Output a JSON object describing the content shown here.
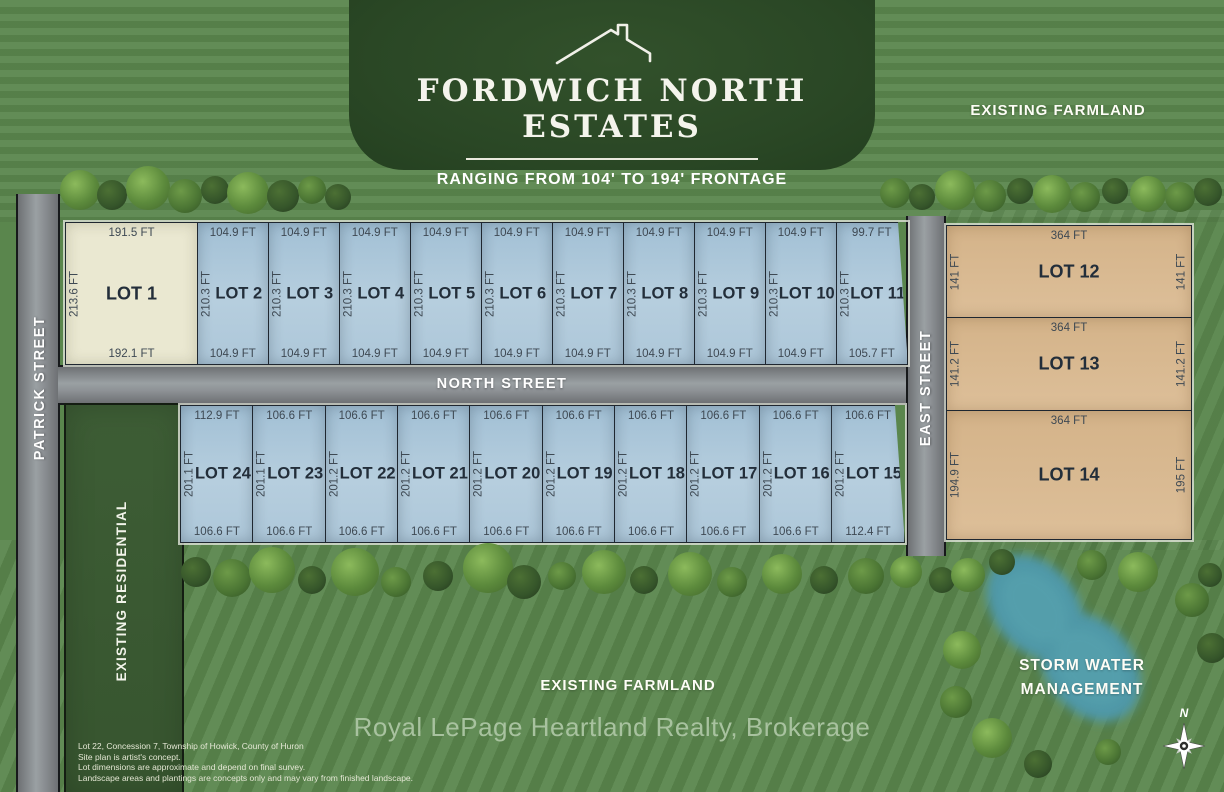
{
  "header": {
    "title": "FORDWICH NORTH ESTATES",
    "subtitle": "RANGING FROM  104' TO 194' FRONTAGE"
  },
  "streets": {
    "patrick": "PATRICK STREET",
    "north": "NORTH STREET",
    "east": "EAST STREET"
  },
  "areas": {
    "existing_farmland_top": "EXISTING FARMLAND",
    "existing_farmland_bottom": "EXISTING FARMLAND",
    "existing_residential": "EXISTING RESIDENTIAL",
    "storm_water_line1": "STORM WATER",
    "storm_water_line2": "MANAGEMENT"
  },
  "compass": {
    "north": "N"
  },
  "footer": {
    "brokerage": "Royal LePage Heartland Realty, Brokerage"
  },
  "disclaimer": [
    "Lot 22, Concession 7, Township of Howick, County of Huron",
    "Site plan is artist's concept.",
    "Lot dimensions are approximate and depend on final survey.",
    "Landscape areas and plantings are concepts only and may vary from finished landscape."
  ],
  "lots": {
    "top_row": [
      {
        "name": "lot-1",
        "label": "LOT 1",
        "top_dim": "191.5 FT",
        "bottom_dim": "192.1 FT",
        "side_dim": "213.6 FT",
        "fill": "cream"
      },
      {
        "name": "lot-2",
        "label": "LOT 2",
        "top_dim": "104.9 FT",
        "bottom_dim": "104.9 FT",
        "side_dim": "210.3 FT",
        "fill": "blue"
      },
      {
        "name": "lot-3",
        "label": "LOT 3",
        "top_dim": "104.9 FT",
        "bottom_dim": "104.9 FT",
        "side_dim": "210.3 FT",
        "fill": "blue"
      },
      {
        "name": "lot-4",
        "label": "LOT 4",
        "top_dim": "104.9 FT",
        "bottom_dim": "104.9 FT",
        "side_dim": "210.3 FT",
        "fill": "blue"
      },
      {
        "name": "lot-5",
        "label": "LOT 5",
        "top_dim": "104.9 FT",
        "bottom_dim": "104.9 FT",
        "side_dim": "210.3 FT",
        "fill": "blue"
      },
      {
        "name": "lot-6",
        "label": "LOT 6",
        "top_dim": "104.9 FT",
        "bottom_dim": "104.9 FT",
        "side_dim": "210.3 FT",
        "fill": "blue"
      },
      {
        "name": "lot-7",
        "label": "LOT 7",
        "top_dim": "104.9 FT",
        "bottom_dim": "104.9 FT",
        "side_dim": "210.3 FT",
        "fill": "blue"
      },
      {
        "name": "lot-8",
        "label": "LOT 8",
        "top_dim": "104.9 FT",
        "bottom_dim": "104.9 FT",
        "side_dim": "210.3 FT",
        "fill": "blue"
      },
      {
        "name": "lot-9",
        "label": "LOT 9",
        "top_dim": "104.9 FT",
        "bottom_dim": "104.9 FT",
        "side_dim": "210.3 FT",
        "fill": "blue"
      },
      {
        "name": "lot-10",
        "label": "LOT 10",
        "top_dim": "104.9 FT",
        "bottom_dim": "104.9 FT",
        "side_dim": "210.3 FT",
        "fill": "blue"
      },
      {
        "name": "lot-11",
        "label": "LOT 11",
        "top_dim": "99.7 FT",
        "bottom_dim": "105.7 FT",
        "side_dim": "210.3 FT",
        "fill": "blue",
        "slant_right": true
      }
    ],
    "east_row": [
      {
        "name": "lot-12",
        "label": "LOT 12",
        "top_dim": "364 FT",
        "left_dim": "141 FT",
        "right_dim": "141 FT",
        "height": 91
      },
      {
        "name": "lot-13",
        "label": "LOT 13",
        "top_dim": "364 FT",
        "left_dim": "141.2 FT",
        "right_dim": "141.2 FT",
        "height": 93
      },
      {
        "name": "lot-14",
        "label": "LOT 14",
        "top_dim": "364 FT",
        "left_dim": "194.9 FT",
        "right_dim": "195 FT",
        "height": 128
      }
    ],
    "bottom_row": [
      {
        "name": "lot-24",
        "label": "LOT 24",
        "top_dim": "112.9 FT",
        "bottom_dim": "106.6 FT",
        "side_dim": "201.1 FT",
        "fill": "blue"
      },
      {
        "name": "lot-23",
        "label": "LOT 23",
        "top_dim": "106.6 FT",
        "bottom_dim": "106.6 FT",
        "side_dim": "201.1 FT",
        "fill": "blue"
      },
      {
        "name": "lot-22",
        "label": "LOT 22",
        "top_dim": "106.6 FT",
        "bottom_dim": "106.6 FT",
        "side_dim": "201.2 FT",
        "fill": "blue"
      },
      {
        "name": "lot-21",
        "label": "LOT 21",
        "top_dim": "106.6 FT",
        "bottom_dim": "106.6 FT",
        "side_dim": "201.2 FT",
        "fill": "blue"
      },
      {
        "name": "lot-20",
        "label": "LOT 20",
        "top_dim": "106.6 FT",
        "bottom_dim": "106.6 FT",
        "side_dim": "201.2 FT",
        "fill": "blue"
      },
      {
        "name": "lot-19",
        "label": "LOT 19",
        "top_dim": "106.6 FT",
        "bottom_dim": "106.6 FT",
        "side_dim": "201.2 FT",
        "fill": "blue"
      },
      {
        "name": "lot-18",
        "label": "LOT 18",
        "top_dim": "106.6 FT",
        "bottom_dim": "106.6 FT",
        "side_dim": "201.2 FT",
        "fill": "blue"
      },
      {
        "name": "lot-17",
        "label": "LOT 17",
        "top_dim": "106.6 FT",
        "bottom_dim": "106.6 FT",
        "side_dim": "201.2 FT",
        "fill": "blue"
      },
      {
        "name": "lot-16",
        "label": "LOT 16",
        "top_dim": "106.6 FT",
        "bottom_dim": "106.6 FT",
        "side_dim": "201.2 FT",
        "fill": "blue"
      },
      {
        "name": "lot-15",
        "label": "LOT 15",
        "top_dim": "106.6 FT",
        "bottom_dim": "112.4 FT",
        "side_dim": "201.2 FT",
        "fill": "blue",
        "slant_right": true
      }
    ]
  },
  "colors": {
    "title_green": "#2c4827",
    "grass": "#5a864d",
    "road_gray": "#8e9296",
    "lot_blue": "#aac6d9",
    "lot_cream": "#eae8d1",
    "lot_tan": "#d8b78e",
    "pond_teal": "#4f98a7",
    "brokerage_text": "#a8c29f"
  }
}
